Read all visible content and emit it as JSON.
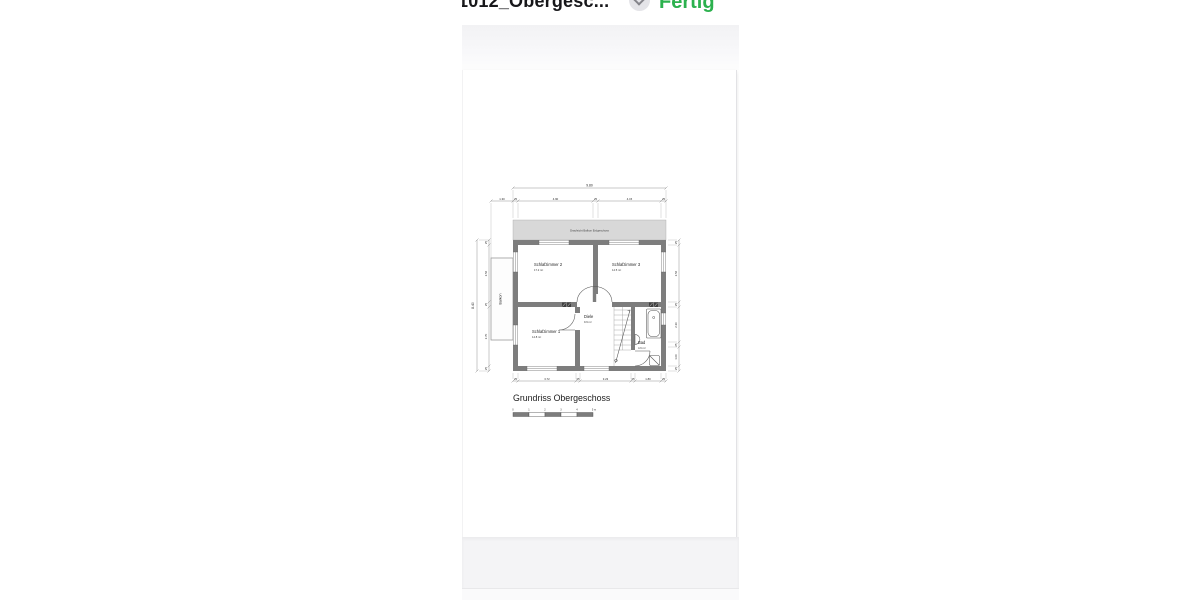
{
  "navbar": {
    "title": "1012_Obergesc...",
    "done_label": "Fertig",
    "accent_green": "#2CB14E"
  },
  "plan": {
    "title": "Grundriss Obergeschoss",
    "balcony_band_label": "Draufsicht Balkon Erdgeschoss",
    "rooms": {
      "schlafzimmer2": {
        "name": "Schlafzimmer 2",
        "area": "17.2 m²"
      },
      "schlafzimmer3": {
        "name": "Schlafzimmer 3",
        "area": "14.5 m²"
      },
      "schlafzimmer1": {
        "name": "Schlafzimmer 1",
        "area": "14.8 m²"
      },
      "diele": {
        "name": "Diele",
        "area": "9.9 m²"
      },
      "bad": {
        "name": "Bad",
        "area": "4.6 m²"
      },
      "balkon": {
        "name": "Balkon"
      }
    },
    "dimensions": {
      "overall_width": "9.80",
      "overall_height": "8.40",
      "top_chain": [
        "1.30",
        "25",
        "4.90",
        "25",
        "4.15",
        "25"
      ],
      "bottom_chain": [
        "25",
        "3.72",
        "25",
        "3.23",
        "25",
        "1.80",
        "25"
      ],
      "left_chain": [
        "25",
        "3.56",
        "25",
        "3.70",
        "25"
      ],
      "right_chain": [
        "25",
        "3.56",
        "25",
        "2.36",
        "25",
        "1.00",
        "25"
      ]
    },
    "scale_bar": [
      "0",
      "1",
      "2",
      "3",
      "4",
      "5 m"
    ]
  }
}
